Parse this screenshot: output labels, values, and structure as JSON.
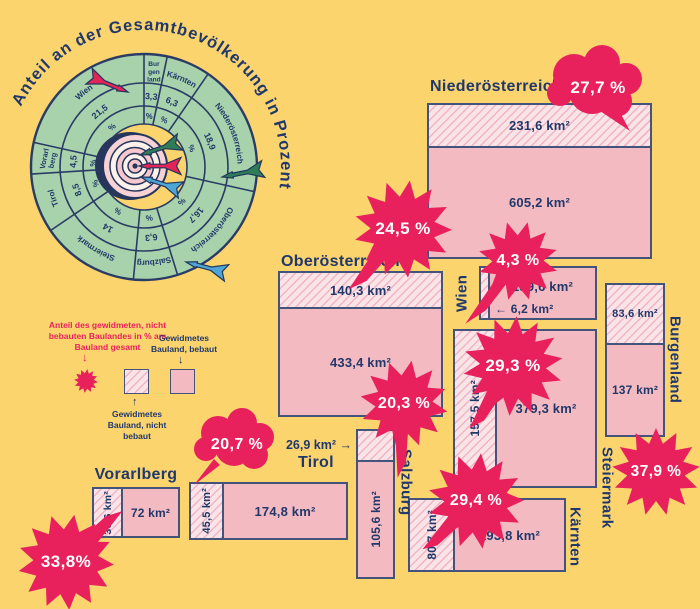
{
  "colors": {
    "background": "#FBD46E",
    "ink_navy": "#21386B",
    "box_border": "#44537A",
    "accent_crimson": "#E8215D",
    "built_pink": "#F4BAC1",
    "unbuilt_pink_light": "#FAE4E7",
    "unbuilt_pink_stripe": "#EFB5C2",
    "donut_green": "#A8D2AB",
    "dart_red": "#E32459",
    "dart_green": "#2E7D58",
    "dart_blue": "#4EA6D6"
  },
  "chart_data": [
    {
      "type": "pie",
      "title": "Anteil an der Gesamtbevölkerung in Prozent",
      "unit": "%",
      "legend_position": "none",
      "center_icon": "dartboard-target-with-darts",
      "segments": [
        {
          "label": "Burgenland",
          "value": 3.3,
          "display": "3,3"
        },
        {
          "label": "Kärnten",
          "value": 6.3,
          "display": "6,3"
        },
        {
          "label": "Niederösterreich",
          "value": 18.9,
          "display": "18,9"
        },
        {
          "label": "Oberösterreich",
          "value": 16.7,
          "display": "16,7"
        },
        {
          "label": "Salzburg",
          "value": 6.3,
          "display": "6,3"
        },
        {
          "label": "Steiermark",
          "value": 14,
          "display": "14"
        },
        {
          "label": "Tirol",
          "value": 8.5,
          "display": "8,5"
        },
        {
          "label": "Vorarlberg",
          "value": 4.5,
          "display": "4,5"
        },
        {
          "label": "Wien",
          "value": 21.5,
          "display": "21,5"
        }
      ]
    },
    {
      "type": "table",
      "columns": [
        "Bundesland",
        "Gewidmetes Bauland, nicht bebaut (km²)",
        "Gewidmetes Bauland, bebaut (km²)",
        "Anteil des gewidmeten, nicht bebauten Baulandes in % am Bauland gesamt"
      ],
      "rows": [
        [
          "Niederösterreich",
          231.6,
          605.2,
          27.7
        ],
        [
          "Oberösterreich",
          140.3,
          433.4,
          24.5
        ],
        [
          "Wien",
          6.2,
          139.6,
          4.3
        ],
        [
          "Burgenland",
          83.6,
          137,
          37.9
        ],
        [
          "Steiermark",
          157.5,
          379.3,
          29.3
        ],
        [
          "Salzburg",
          26.9,
          105.6,
          20.3
        ],
        [
          "Tirol",
          45.5,
          174.8,
          20.7
        ],
        [
          "Kärnten",
          80.7,
          193.8,
          29.4
        ],
        [
          "Vorarlberg",
          36.6,
          72,
          33.8
        ]
      ]
    }
  ],
  "legend": {
    "pct_label": "Anteil des gewidmeten, nicht bebauten Baulandes in % am Bauland gesamt",
    "built_label": "Gewidmetes Bauland, bebaut",
    "unbuilt_label": "Gewidmetes Bauland, nicht bebaut",
    "arrow_down": "↓",
    "arrow_up": "↑"
  },
  "states": {
    "niederoesterreich": {
      "title": "Niederösterreich",
      "unbuilt": "231,6 km²",
      "built": "605,2 km²",
      "pct": "27,7 %"
    },
    "oberoesterreich": {
      "title": "Oberösterreich",
      "unbuilt": "140,3 km²",
      "built": "433,4 km²",
      "pct": "24,5 %"
    },
    "wien": {
      "title": "Wien",
      "unbuilt": "← 6,2 km²",
      "built": "139,6 km²",
      "pct": "4,3 %"
    },
    "burgenland": {
      "title": "Burgenland",
      "unbuilt": "83,6 km²",
      "built": "137 km²",
      "pct": "37,9 %"
    },
    "steiermark": {
      "title": "Steiermark",
      "unbuilt": "157,5 km²",
      "built": "379,3 km²",
      "pct": "29,3 %"
    },
    "salzburg": {
      "title": "Salzburg",
      "unbuilt": "26,9 km² →",
      "built": "105,6 km²",
      "pct": "20,3 %"
    },
    "tirol": {
      "title": "Tirol",
      "unbuilt": "45,5 km²",
      "built": "174,8 km²",
      "pct": "20,7 %"
    },
    "kaernten": {
      "title": "Kärnten",
      "unbuilt": "80,7 km²",
      "built": "193,8 km²",
      "pct": "29,4 %"
    },
    "vorarlberg": {
      "title": "Vorarlberg",
      "unbuilt": "36,6 km²",
      "built": "72 km²",
      "pct": "33,8%"
    }
  }
}
